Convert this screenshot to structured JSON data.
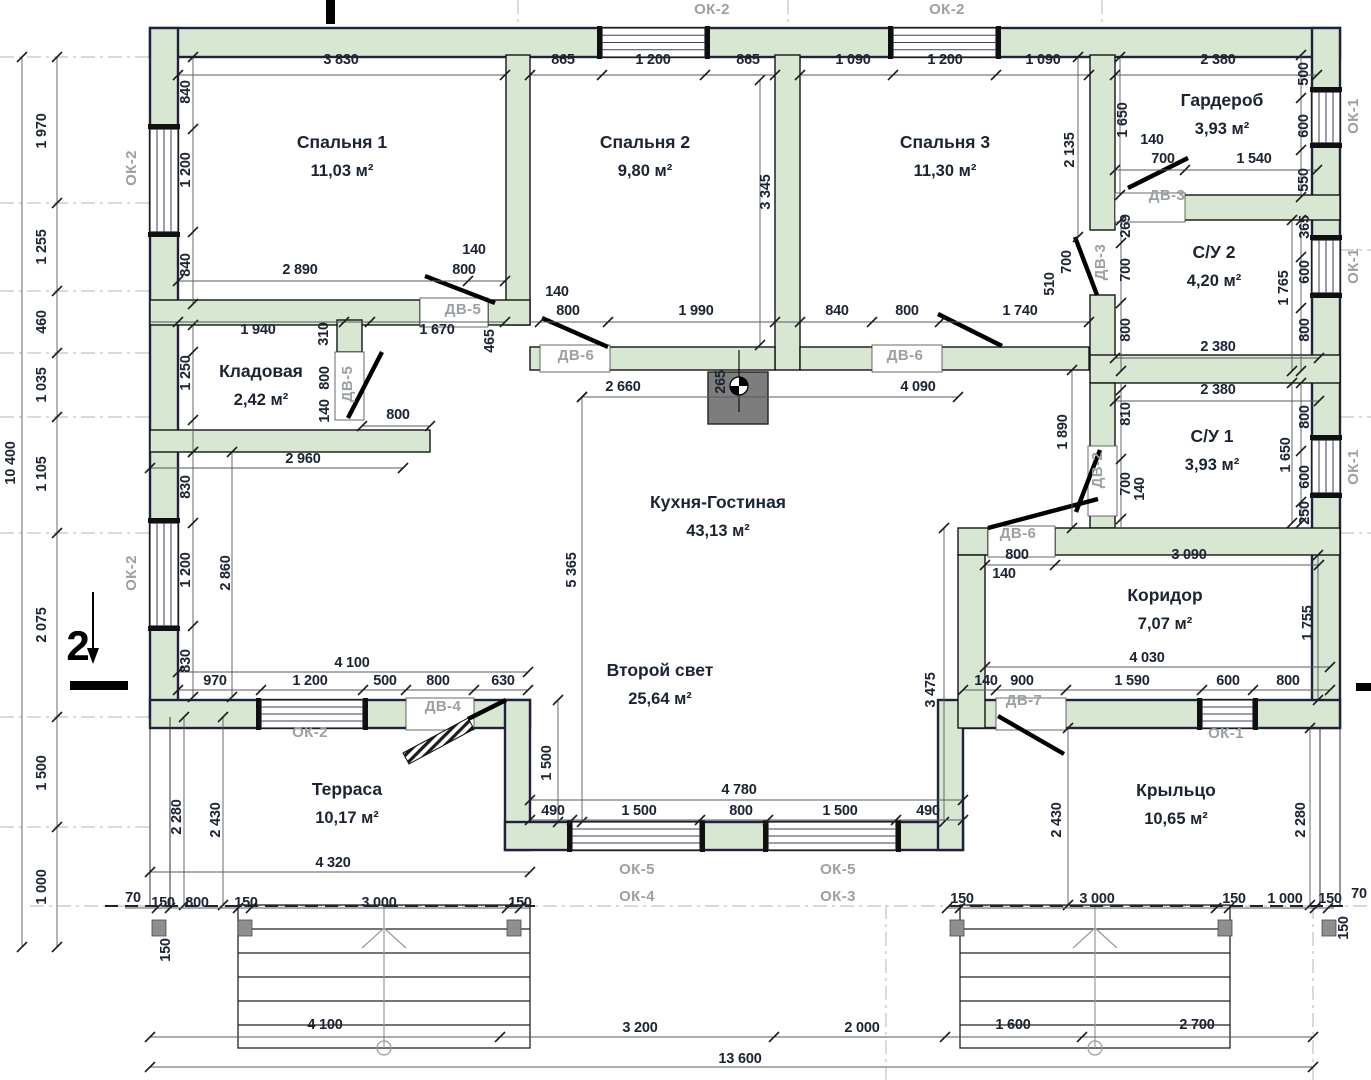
{
  "drawing": {
    "type": "floor-plan",
    "section_marker": {
      "label": "2",
      "x": 78,
      "y": 660
    }
  },
  "colors": {
    "wall_fill": "#d8e7d2",
    "exterior_outline": "#20203f",
    "interior_outline": "#141414",
    "dimension_text": "#1b2433",
    "tag_text": "#9aa0a3",
    "chimney": "#7d7d7d"
  },
  "rooms": [
    {
      "name": "Спальня 1",
      "area": "11,03 м²",
      "x": 342,
      "y": 148
    },
    {
      "name": "Спальня 2",
      "area": "9,80 м²",
      "x": 645,
      "y": 148
    },
    {
      "name": "Спальня 3",
      "area": "11,30 м²",
      "x": 945,
      "y": 148
    },
    {
      "name": "Гардероб",
      "area": "3,93 м²",
      "x": 1222,
      "y": 106
    },
    {
      "name": "С/У 2",
      "area": "4,20 м²",
      "x": 1214,
      "y": 258
    },
    {
      "name": "С/У 1",
      "area": "3,93 м²",
      "x": 1212,
      "y": 442
    },
    {
      "name": "Кладовая",
      "area": "2,42 м²",
      "x": 261,
      "y": 377
    },
    {
      "name": "Кухня-Гостиная",
      "area": "43,13 м²",
      "x": 718,
      "y": 508
    },
    {
      "name": "Второй свет",
      "area": "25,64 м²",
      "x": 660,
      "y": 676
    },
    {
      "name": "Терраса",
      "area": "10,17 м²",
      "x": 347,
      "y": 795
    },
    {
      "name": "Коридор",
      "area": "7,07 м²",
      "x": 1165,
      "y": 601
    },
    {
      "name": "Крыльцо",
      "area": "10,65 м²",
      "x": 1176,
      "y": 796
    }
  ],
  "window_tags": [
    {
      "t": "ОК-2",
      "x": 712,
      "y": 14
    },
    {
      "t": "ОК-2",
      "x": 947,
      "y": 14
    },
    {
      "t": "ОК-2",
      "x": 136,
      "y": 168,
      "r": -90
    },
    {
      "t": "ОК-2",
      "x": 136,
      "y": 573,
      "r": -90
    },
    {
      "t": "ОК-1",
      "x": 1358,
      "y": 116,
      "r": -90
    },
    {
      "t": "ОК-1",
      "x": 1358,
      "y": 266,
      "r": -90
    },
    {
      "t": "ОК-1",
      "x": 1358,
      "y": 467,
      "r": -90
    },
    {
      "t": "ОК-2",
      "x": 310,
      "y": 737
    },
    {
      "t": "ОК-1",
      "x": 1226,
      "y": 738
    },
    {
      "t": "ОК-5",
      "x": 637,
      "y": 874
    },
    {
      "t": "ОК-4",
      "x": 637,
      "y": 901
    },
    {
      "t": "ОК-5",
      "x": 838,
      "y": 874
    },
    {
      "t": "ОК-3",
      "x": 838,
      "y": 901
    }
  ],
  "door_tags": [
    {
      "t": "ДВ-5",
      "x": 463,
      "y": 314
    },
    {
      "t": "ДВ-5",
      "x": 352,
      "y": 384,
      "r": -90
    },
    {
      "t": "ДВ-6",
      "x": 576,
      "y": 360
    },
    {
      "t": "ДВ-6",
      "x": 905,
      "y": 360
    },
    {
      "t": "ДВ-6",
      "x": 1018,
      "y": 538
    },
    {
      "t": "ДВ-3",
      "x": 1167,
      "y": 200
    },
    {
      "t": "ДВ-3",
      "x": 1105,
      "y": 262,
      "r": -90
    },
    {
      "t": "ДВ-2",
      "x": 1102,
      "y": 470,
      "r": -90
    },
    {
      "t": "ДВ-7",
      "x": 1024,
      "y": 705
    },
    {
      "t": "ДВ-4",
      "x": 443,
      "y": 711
    }
  ],
  "dimensions": [
    {
      "t": "3 830",
      "x": 341,
      "y": 64
    },
    {
      "t": "865",
      "x": 563,
      "y": 64
    },
    {
      "t": "1 200",
      "x": 653,
      "y": 64
    },
    {
      "t": "865",
      "x": 748,
      "y": 64
    },
    {
      "t": "1 090",
      "x": 853,
      "y": 64
    },
    {
      "t": "1 200",
      "x": 945,
      "y": 64
    },
    {
      "t": "1 090",
      "x": 1043,
      "y": 64
    },
    {
      "t": "2 380",
      "x": 1218,
      "y": 64
    },
    {
      "t": "2 890",
      "x": 300,
      "y": 274
    },
    {
      "t": "140",
      "x": 474,
      "y": 254
    },
    {
      "t": "800",
      "x": 464,
      "y": 274
    },
    {
      "t": "1 940",
      "x": 258,
      "y": 334
    },
    {
      "t": "1 670",
      "x": 437,
      "y": 334
    },
    {
      "t": "140",
      "x": 557,
      "y": 296
    },
    {
      "t": "800",
      "x": 568,
      "y": 315
    },
    {
      "t": "1 990",
      "x": 696,
      "y": 315
    },
    {
      "t": "840",
      "x": 837,
      "y": 315
    },
    {
      "t": "800",
      "x": 907,
      "y": 315
    },
    {
      "t": "1 740",
      "x": 1020,
      "y": 315
    },
    {
      "t": "140",
      "x": 1152,
      "y": 144
    },
    {
      "t": "700",
      "x": 1163,
      "y": 163
    },
    {
      "t": "1 540",
      "x": 1254,
      "y": 163
    },
    {
      "t": "2 380",
      "x": 1218,
      "y": 351
    },
    {
      "t": "2 380",
      "x": 1218,
      "y": 394
    },
    {
      "t": "2 660",
      "x": 623,
      "y": 391
    },
    {
      "t": "4 090",
      "x": 918,
      "y": 391
    },
    {
      "t": "800",
      "x": 398,
      "y": 419
    },
    {
      "t": "2 960",
      "x": 303,
      "y": 463
    },
    {
      "t": "4 100",
      "x": 352,
      "y": 667
    },
    {
      "t": "970",
      "x": 215,
      "y": 685
    },
    {
      "t": "1 200",
      "x": 310,
      "y": 685
    },
    {
      "t": "500",
      "x": 385,
      "y": 685
    },
    {
      "t": "800",
      "x": 438,
      "y": 685
    },
    {
      "t": "630",
      "x": 503,
      "y": 685
    },
    {
      "t": "800",
      "x": 1017,
      "y": 559
    },
    {
      "t": "140",
      "x": 1004,
      "y": 578
    },
    {
      "t": "3 090",
      "x": 1189,
      "y": 559
    },
    {
      "t": "4 030",
      "x": 1147,
      "y": 662
    },
    {
      "t": "140",
      "x": 986,
      "y": 685
    },
    {
      "t": "900",
      "x": 1022,
      "y": 685
    },
    {
      "t": "1 590",
      "x": 1132,
      "y": 685
    },
    {
      "t": "600",
      "x": 1228,
      "y": 685
    },
    {
      "t": "800",
      "x": 1288,
      "y": 685
    },
    {
      "t": "4 780",
      "x": 739,
      "y": 794
    },
    {
      "t": "490",
      "x": 553,
      "y": 815
    },
    {
      "t": "1 500",
      "x": 639,
      "y": 815
    },
    {
      "t": "800",
      "x": 741,
      "y": 815
    },
    {
      "t": "1 500",
      "x": 840,
      "y": 815
    },
    {
      "t": "490",
      "x": 928,
      "y": 815
    },
    {
      "t": "4 320",
      "x": 333,
      "y": 867
    },
    {
      "t": "70",
      "x": 133,
      "y": 902
    },
    {
      "t": "150",
      "x": 163,
      "y": 907
    },
    {
      "t": "800",
      "x": 197,
      "y": 907
    },
    {
      "t": "150",
      "x": 246,
      "y": 907
    },
    {
      "t": "3 000",
      "x": 379,
      "y": 907
    },
    {
      "t": "150",
      "x": 520,
      "y": 907
    },
    {
      "t": "150",
      "x": 962,
      "y": 903
    },
    {
      "t": "3 000",
      "x": 1097,
      "y": 903
    },
    {
      "t": "150",
      "x": 1234,
      "y": 903
    },
    {
      "t": "1 000",
      "x": 1285,
      "y": 903
    },
    {
      "t": "150",
      "x": 1330,
      "y": 903
    },
    {
      "t": "70",
      "x": 1359,
      "y": 898
    },
    {
      "t": "4 100",
      "x": 325,
      "y": 1029
    },
    {
      "t": "3 200",
      "x": 640,
      "y": 1032
    },
    {
      "t": "2 000",
      "x": 862,
      "y": 1032
    },
    {
      "t": "1 600",
      "x": 1013,
      "y": 1029
    },
    {
      "t": "2 700",
      "x": 1197,
      "y": 1029
    },
    {
      "t": "13 600",
      "x": 740,
      "y": 1063
    },
    {
      "t": "840",
      "x": 190,
      "y": 92,
      "r": -90
    },
    {
      "t": "1 200",
      "x": 190,
      "y": 170,
      "r": -90
    },
    {
      "t": "840",
      "x": 190,
      "y": 265,
      "r": -90
    },
    {
      "t": "3 345",
      "x": 770,
      "y": 192,
      "r": -90
    },
    {
      "t": "2 135",
      "x": 1074,
      "y": 150,
      "r": -90
    },
    {
      "t": "1 650",
      "x": 1127,
      "y": 120,
      "r": -90
    },
    {
      "t": "500",
      "x": 1308,
      "y": 74,
      "r": -90
    },
    {
      "t": "600",
      "x": 1308,
      "y": 126,
      "r": -90
    },
    {
      "t": "550",
      "x": 1308,
      "y": 180,
      "r": -90
    },
    {
      "t": "269",
      "x": 1130,
      "y": 226,
      "r": -90
    },
    {
      "t": "700",
      "x": 1130,
      "y": 270,
      "r": -90
    },
    {
      "t": "800",
      "x": 1130,
      "y": 330,
      "r": -90
    },
    {
      "t": "1 765",
      "x": 1288,
      "y": 288,
      "r": -90
    },
    {
      "t": "365",
      "x": 1309,
      "y": 227,
      "r": -90
    },
    {
      "t": "600",
      "x": 1309,
      "y": 272,
      "r": -90
    },
    {
      "t": "800",
      "x": 1309,
      "y": 330,
      "r": -90
    },
    {
      "t": "510",
      "x": 1054,
      "y": 284,
      "r": -90
    },
    {
      "t": "700",
      "x": 1071,
      "y": 262,
      "r": -90
    },
    {
      "t": "1 250",
      "x": 190,
      "y": 373,
      "r": -90
    },
    {
      "t": "310",
      "x": 328,
      "y": 334,
      "r": -90
    },
    {
      "t": "800",
      "x": 329,
      "y": 378,
      "r": -90
    },
    {
      "t": "140",
      "x": 329,
      "y": 411,
      "r": -90
    },
    {
      "t": "465",
      "x": 494,
      "y": 341,
      "r": -90
    },
    {
      "t": "265",
      "x": 725,
      "y": 382,
      "r": -90
    },
    {
      "t": "810",
      "x": 1130,
      "y": 414,
      "r": -90
    },
    {
      "t": "700",
      "x": 1130,
      "y": 484,
      "r": -90
    },
    {
      "t": "140",
      "x": 1144,
      "y": 489,
      "r": -90
    },
    {
      "t": "1 890",
      "x": 1067,
      "y": 432,
      "r": -90
    },
    {
      "t": "800",
      "x": 1309,
      "y": 417,
      "r": -90
    },
    {
      "t": "1 650",
      "x": 1290,
      "y": 455,
      "r": -90
    },
    {
      "t": "600",
      "x": 1309,
      "y": 477,
      "r": -90
    },
    {
      "t": "250",
      "x": 1309,
      "y": 513,
      "r": -90
    },
    {
      "t": "830",
      "x": 190,
      "y": 487,
      "r": -90
    },
    {
      "t": "1 200",
      "x": 190,
      "y": 570,
      "r": -90
    },
    {
      "t": "2 860",
      "x": 230,
      "y": 573,
      "r": -90
    },
    {
      "t": "5 365",
      "x": 576,
      "y": 570,
      "r": -90
    },
    {
      "t": "830",
      "x": 190,
      "y": 661,
      "r": -90
    },
    {
      "t": "1 500",
      "x": 551,
      "y": 763,
      "r": -90
    },
    {
      "t": "3 475",
      "x": 935,
      "y": 690,
      "r": -90
    },
    {
      "t": "2 280",
      "x": 181,
      "y": 817,
      "r": -90
    },
    {
      "t": "2 430",
      "x": 220,
      "y": 820,
      "r": -90
    },
    {
      "t": "2 430",
      "x": 1061,
      "y": 820,
      "r": -90
    },
    {
      "t": "2 280",
      "x": 1305,
      "y": 820,
      "r": -90
    },
    {
      "t": "1 755",
      "x": 1312,
      "y": 623,
      "r": -90
    },
    {
      "t": "150",
      "x": 170,
      "y": 950,
      "r": -90
    },
    {
      "t": "150",
      "x": 1348,
      "y": 928,
      "r": -90
    },
    {
      "t": "1 970",
      "x": 46,
      "y": 131,
      "r": -90
    },
    {
      "t": "1 255",
      "x": 46,
      "y": 247,
      "r": -90
    },
    {
      "t": "460",
      "x": 46,
      "y": 322,
      "r": -90
    },
    {
      "t": "1 035",
      "x": 46,
      "y": 385,
      "r": -90
    },
    {
      "t": "1 105",
      "x": 46,
      "y": 474,
      "r": -90
    },
    {
      "t": "10 400",
      "x": 15,
      "y": 463,
      "r": -90
    },
    {
      "t": "2 075",
      "x": 46,
      "y": 625,
      "r": -90
    },
    {
      "t": "1 500",
      "x": 46,
      "y": 773,
      "r": -90
    },
    {
      "t": "1 000",
      "x": 46,
      "y": 887,
      "r": -90
    }
  ]
}
